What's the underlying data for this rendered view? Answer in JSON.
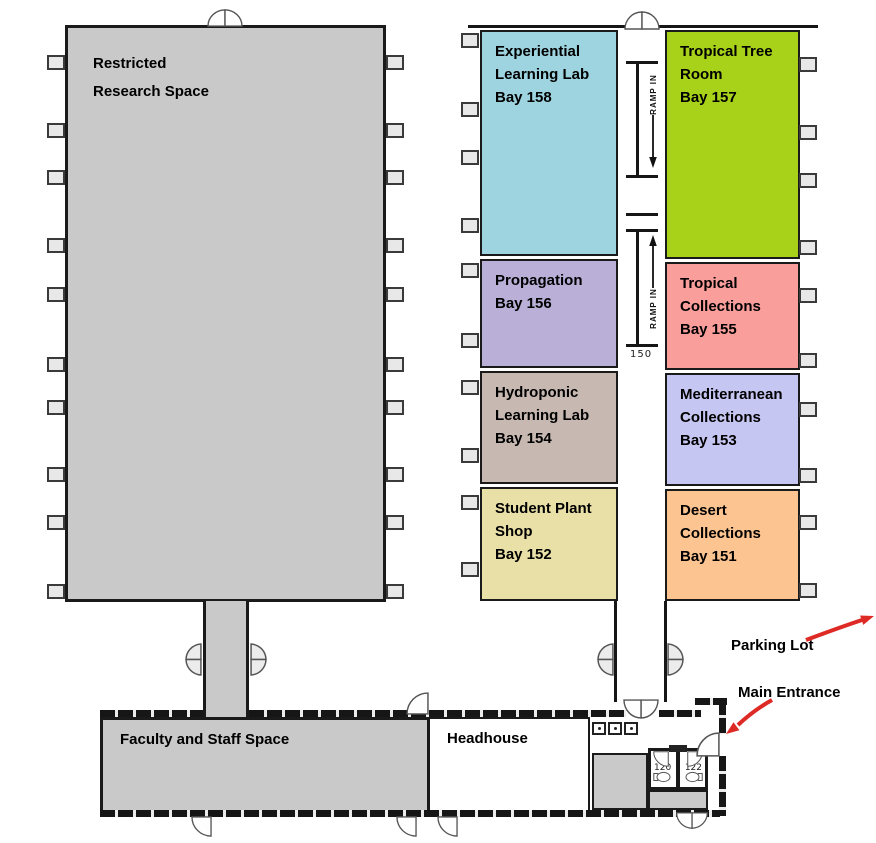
{
  "rooms": {
    "restricted": {
      "lines": [
        "Restricted",
        "Research Space"
      ],
      "color": "#C9C9C9"
    },
    "bay158": {
      "lines": [
        "Experiential",
        "Learning Lab",
        "Bay 158"
      ],
      "color": "#9ED4E0"
    },
    "bay157": {
      "lines": [
        "Tropical Tree",
        "Room",
        "Bay 157"
      ],
      "color": "#A8D21A"
    },
    "bay156": {
      "lines": [
        "Propagation",
        "Bay 156"
      ],
      "color": "#B9AFD7"
    },
    "bay155": {
      "lines": [
        "Tropical",
        "Collections",
        "Bay 155"
      ],
      "color": "#FA9E9B"
    },
    "bay154": {
      "lines": [
        "Hydroponic",
        "Learning Lab",
        "Bay 154"
      ],
      "color": "#C7B9B2"
    },
    "bay153": {
      "lines": [
        "Mediterranean",
        "Collections",
        "Bay 153"
      ],
      "color": "#C6C6F2"
    },
    "bay152": {
      "lines": [
        "Student Plant",
        "Shop",
        "Bay 152"
      ],
      "color": "#E9E0A8"
    },
    "bay151": {
      "lines": [
        "Desert",
        "Collections",
        "Bay 151"
      ],
      "color": "#FCC490"
    },
    "faculty": {
      "label": "Faculty and Staff Space",
      "color": "#C9C9C9"
    },
    "headhouse": {
      "label": "Headhouse",
      "color": "#FFFFFF"
    },
    "restroom_120": {
      "label": "120"
    },
    "restroom_122": {
      "label": "122"
    }
  },
  "corridor": {
    "ramps": [
      {
        "label": "RAMP IN",
        "direction": "down"
      },
      {
        "label": "RAMP IN",
        "direction": "up"
      }
    ],
    "room_number": "150"
  },
  "annotations": {
    "parking": {
      "label": "Parking Lot",
      "arrow_color": "#DE2A25"
    },
    "entrance": {
      "label": "Main Entrance",
      "arrow_color": "#DE2A25"
    }
  }
}
